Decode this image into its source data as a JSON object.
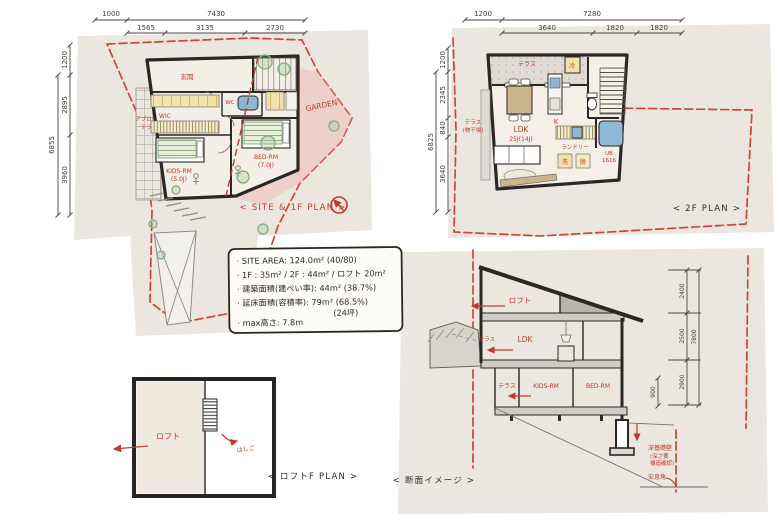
{
  "palette": {
    "ink": "#2e2a26",
    "red": "#c2392b",
    "site_pink": "#f3d6cf",
    "garden_pink": "#efbcb4",
    "paper_wash": "#ebe7df",
    "tatami_yellow": "#efe3ab",
    "bath_blue": "#8cb8d6",
    "bed_green": "#8fae80"
  },
  "plan1f": {
    "caption": "< SITE & 1F PLAN >",
    "dims": {
      "top1": [
        "1000",
        "7430"
      ],
      "top2": [
        "1565",
        "3135",
        "2730"
      ],
      "left_top": "1200",
      "left": [
        "2895",
        "3960"
      ],
      "left_total": "6855"
    },
    "rooms": {
      "genkan": "玄関",
      "wic": "WIC",
      "wc": "WC",
      "kids": "KIDS-RM",
      "kids_size": "(5.0J)",
      "bed": "BED-RM",
      "bed_size": "(7.0J)"
    },
    "site": {
      "garden": "GARDEN",
      "approach_1": "アプローチ",
      "approach_2": "テラス"
    }
  },
  "plan2f": {
    "caption": "< 2F PLAN >",
    "dims": {
      "top1": [
        "1200",
        "7280"
      ],
      "top2": [
        "3640",
        "1820",
        "1820"
      ],
      "left_top": "1200",
      "left": [
        "2345",
        "840",
        "3640"
      ],
      "left_total": "6825"
    },
    "rooms": {
      "terrace": "テラス",
      "ldk": "LDK",
      "ldk_size": "25J(14J)",
      "kitchen": "K",
      "fridge": "冷",
      "laundry": "ランドリー",
      "wash": "洗",
      "dress": "脱",
      "ub": "UB",
      "ub_size": "1616",
      "balcony_1": "テラス",
      "balcony_2": "(物干場)"
    }
  },
  "notes": {
    "lines": [
      "· SITE AREA: 124.0m²  (40/80)",
      "· 1F : 35m² / 2F : 44m² / ロフト 20m²",
      "· 建築面積(建ぺい率): 44m² (38.7%)",
      "· 延床面積(容積率): 79m² (68.5%)",
      "(24坪)",
      "· max高さ: 7.8m"
    ]
  },
  "loft": {
    "caption": "< ロフトF PLAN >",
    "label": "ロフト",
    "ladder": "はしご"
  },
  "section": {
    "caption": "< 断面イメージ >",
    "dims": {
      "segments": [
        "2400",
        "2500",
        "2900"
      ],
      "total": "7800",
      "foundation": "900"
    },
    "labels": {
      "loft": "ロフト",
      "ldk": "LDK",
      "terrace_2f": "テラス",
      "terrace_1f": "テラス",
      "kids": "KIDS-RM",
      "bed": "BED-RM",
      "foundation_1": "深基礎壁",
      "foundation_2": "(深さ要",
      "foundation_3": "構造確認)",
      "angle": "安息角"
    }
  }
}
